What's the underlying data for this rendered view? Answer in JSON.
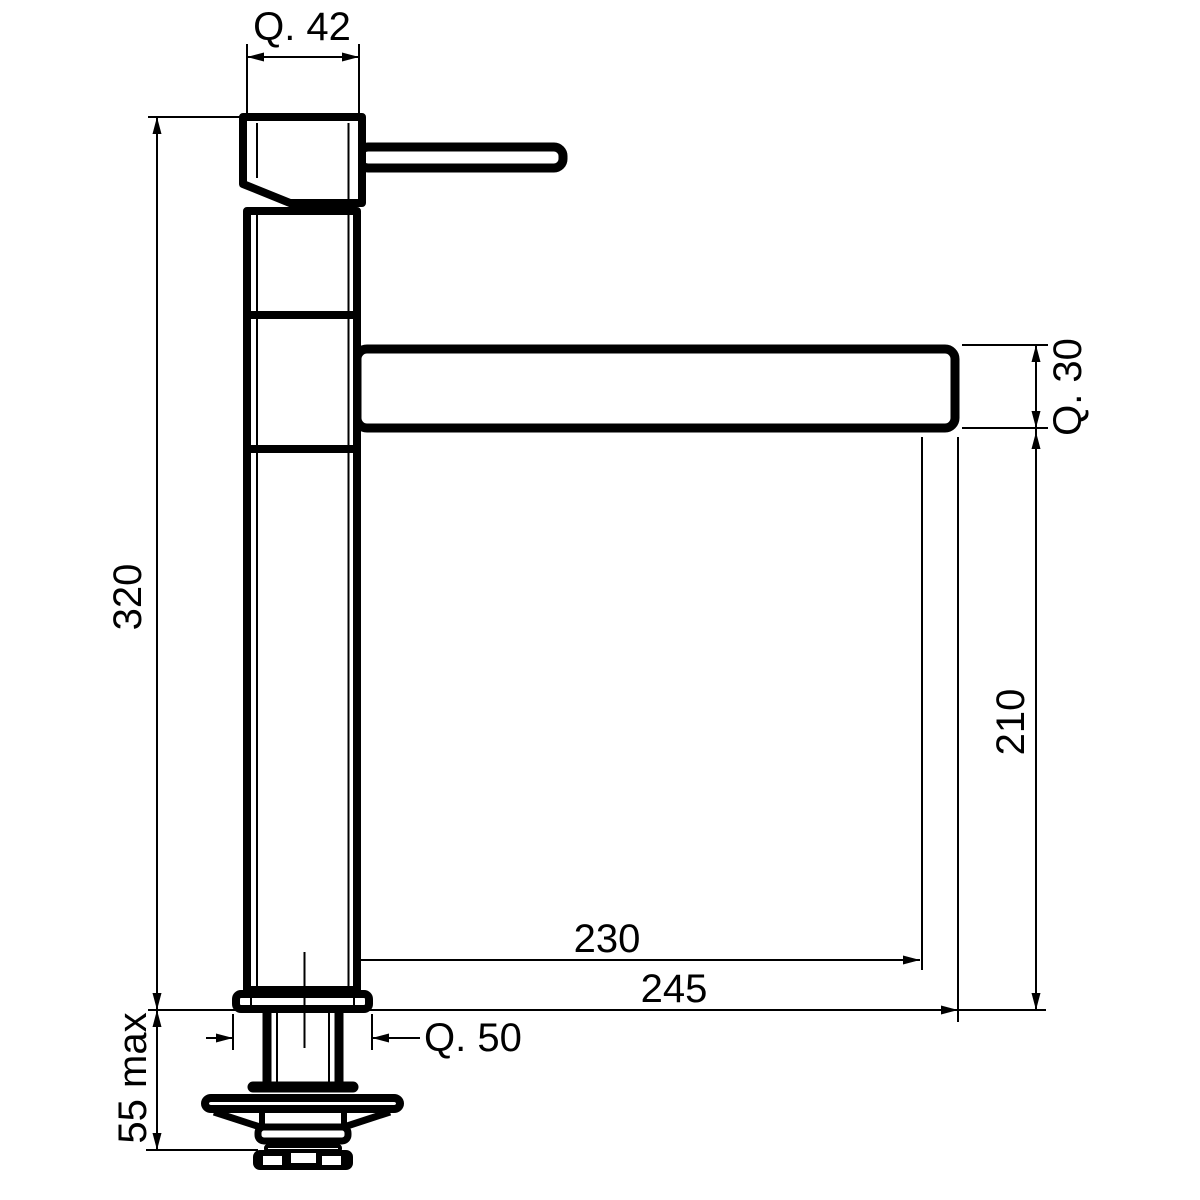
{
  "drawing": {
    "title": "kitchen-mixer-tap-dimension-drawing",
    "view": "side elevation",
    "background_color": "#ffffff",
    "line_color": "#000000",
    "labels": {
      "q42": "Q. 42",
      "h320": "320",
      "q30": "Q. 30",
      "h210": "210",
      "d230": "230",
      "d245": "245",
      "q50": "Q. 50",
      "max55": "55 max"
    }
  }
}
